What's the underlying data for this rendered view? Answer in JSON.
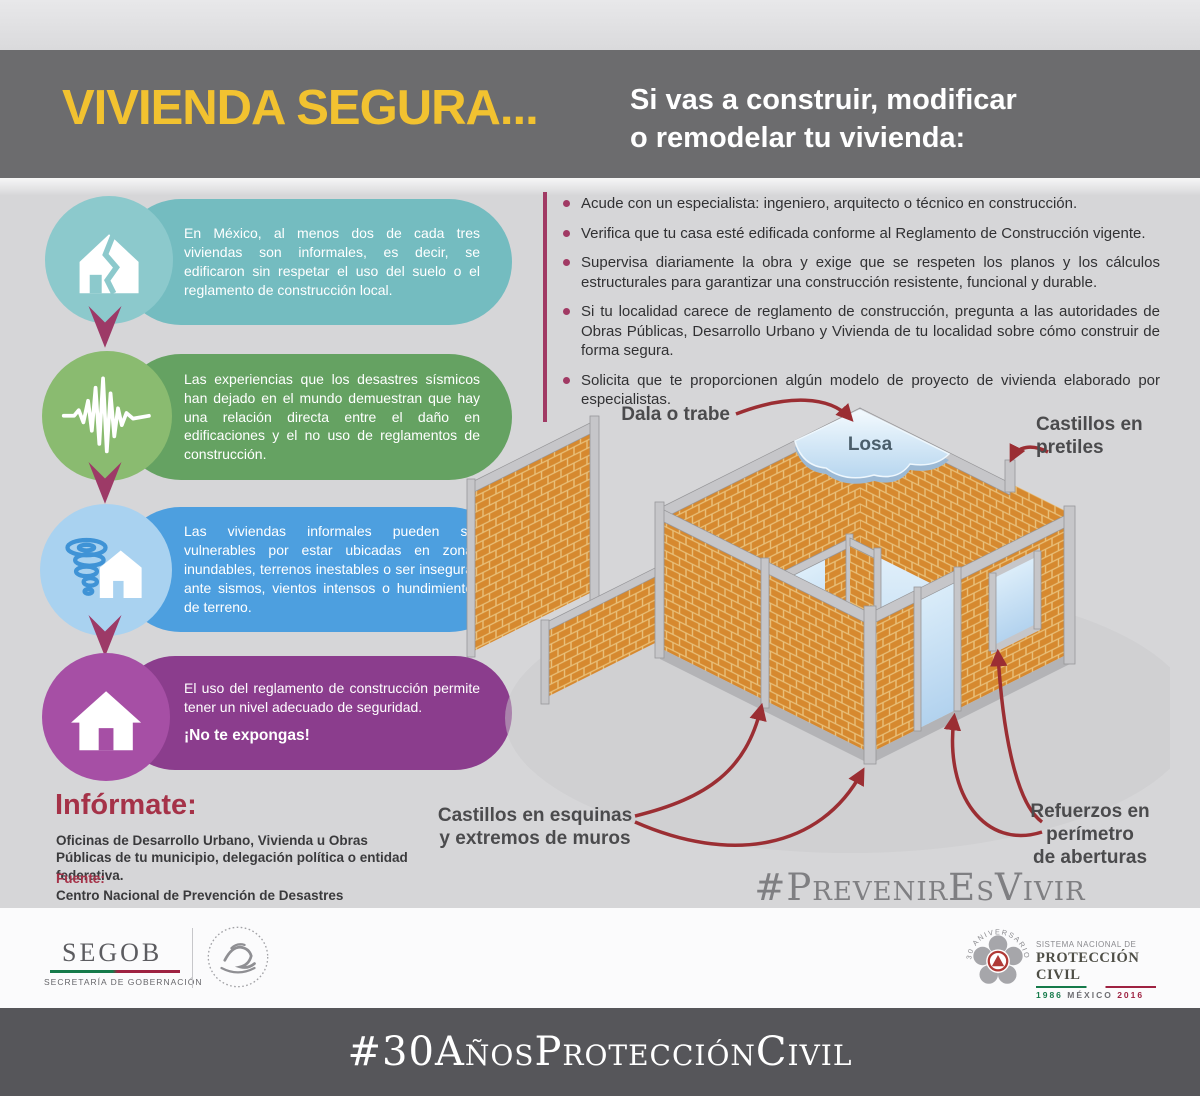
{
  "header": {
    "title": "VIVIENDA SEGURA...",
    "subtitle_line1": "Si vas a construir, modificar",
    "subtitle_line2": "o remodelar tu vivienda:"
  },
  "bubbles": [
    {
      "icon": "cracked-house-icon",
      "text": "En México, al menos dos de cada tres viviendas son informales, es decir, se edificaron sin respetar el uso del suelo o el reglamento de construcción local."
    },
    {
      "icon": "seismograph-icon",
      "text": "Las experiencias que los desastres sísmicos han dejado en el mundo demuestran que hay una relación directa entre el daño en edificaciones y el no uso de reglamentos de construcción."
    },
    {
      "icon": "tornado-house-icon",
      "text": "Las viviendas informales pueden ser vulnerables por estar ubicadas en zonas inundables, terrenos inestables o ser inseguras ante sismos, vientos intensos o hundimientos de terreno."
    },
    {
      "icon": "house-icon",
      "text": "El uso del reglamento de construcción permite tener un nivel adecuado de seguridad.",
      "emphasis": "¡No te expongas!"
    }
  ],
  "bullets": [
    "Acude con un especialista: ingeniero, arquitecto o técnico en construcción.",
    "Verifica que tu casa esté edificada conforme al Reglamento de Construcción vigente.",
    "Supervisa diariamente la obra y exige que se respeten los planos y los cálculos estructurales para garantizar una construcción resistente, funcional y durable.",
    "Si tu localidad carece de reglamento de construcción, pregunta a las autoridades de Obras Públicas, Desarrollo Urbano y Vivienda de tu localidad sobre cómo construir de forma segura.",
    "Solicita que te proporcionen algún modelo de proyecto de vivienda elaborado por especialistas."
  ],
  "informate": {
    "heading": "Infórmate:",
    "body": "Oficinas de Desarrollo Urbano, Vivienda u Obras Públicas de tu municipio, delegación política o entidad federativa.",
    "source_label": "Fuente:",
    "source_body": "Centro Nacional de Prevención de Desastres"
  },
  "diagram": {
    "label_dala": "Dala o trabe",
    "label_losa": "Losa",
    "label_pretiles_line1": "Castillos en",
    "label_pretiles_line2": "pretiles",
    "label_esquinas_line1": "Castillos en esquinas",
    "label_esquinas_line2": "y extremos de muros",
    "label_refuerzos_line1": "Refuerzos en",
    "label_refuerzos_line2": "perímetro",
    "label_refuerzos_line3": "de aberturas",
    "hashtag": "#PrevenirEsVivir"
  },
  "footer": {
    "segob": "SEGOB",
    "segob_subtitle": "SECRETARÍA DE GOBERNACIÓN",
    "anniversary_arc": "30 ANIVERSARIO",
    "snpc_line1": "SISTEMA NACIONAL DE",
    "snpc_line2": "PROTECCIÓN CIVIL",
    "snpc_year_start": "1986",
    "snpc_country": "MÉXICO",
    "snpc_year_end": "2016",
    "hashtag_bar": "#30AñosProtecciónCivil"
  },
  "colors": {
    "title_yellow": "#f2c230",
    "header_gray": "#6c6c6e",
    "teal": "#74bcc0",
    "green": "#65a262",
    "blue": "#4d9fdf",
    "purple": "#8b3d8d",
    "maroon_accent": "#a13a64",
    "arrow_red": "#9b2e33",
    "brick_orange": "#d6892f"
  }
}
